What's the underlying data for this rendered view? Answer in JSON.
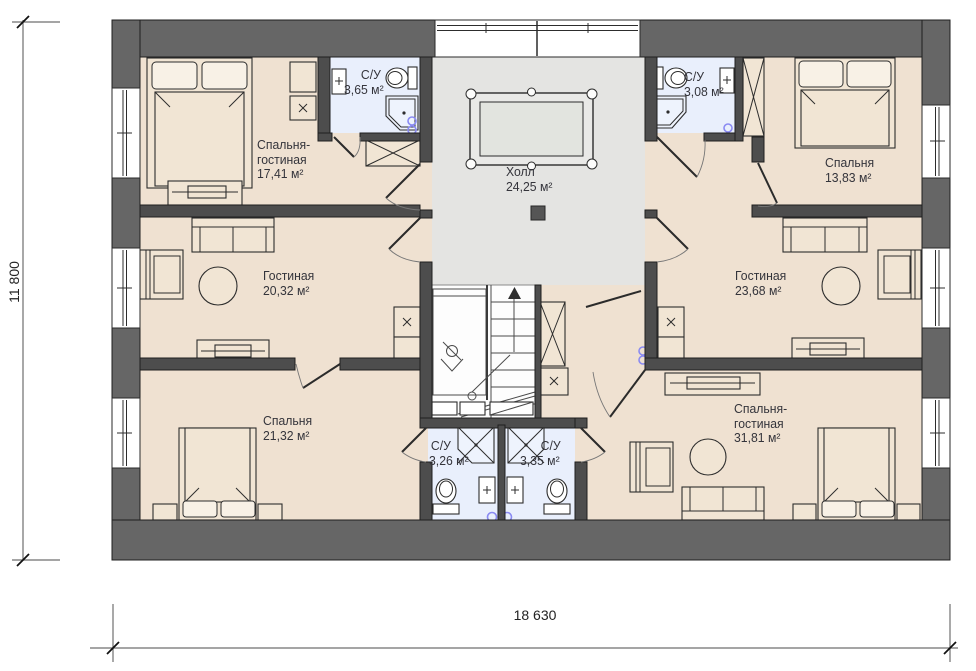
{
  "rooms": [
    {
      "name": "Спальня-гостиная",
      "area": "17,41 м²"
    },
    {
      "name": "С/У",
      "area": "3,65 м²"
    },
    {
      "name": "Холл",
      "area": "24,25 м²"
    },
    {
      "name": "С/У",
      "area": "3,08 м²"
    },
    {
      "name": "Спальня",
      "area": "13,83 м²"
    },
    {
      "name": "Гостиная",
      "area": "20,32 м²"
    },
    {
      "name": "Гостиная",
      "area": "23,68 м²"
    },
    {
      "name": "Спальня",
      "area": "21,32 м²"
    },
    {
      "name": "С/У",
      "area": "3,26 м²"
    },
    {
      "name": "С/У",
      "area": "3,35 м²"
    },
    {
      "name": "Спальня-гостиная",
      "area": "31,81 м²"
    }
  ],
  "dimensions": {
    "height": "11 800",
    "width": "18 630"
  },
  "colors": {
    "wall_outer": "#666666",
    "wall_inner": "#4d4d4d",
    "floor_room": "#efe1d1",
    "floor_bath": "#e9effc",
    "floor_hall": "#e4e4e2",
    "floor_stair": "#fdfdfd",
    "accent_blue": "#8a8af2"
  }
}
